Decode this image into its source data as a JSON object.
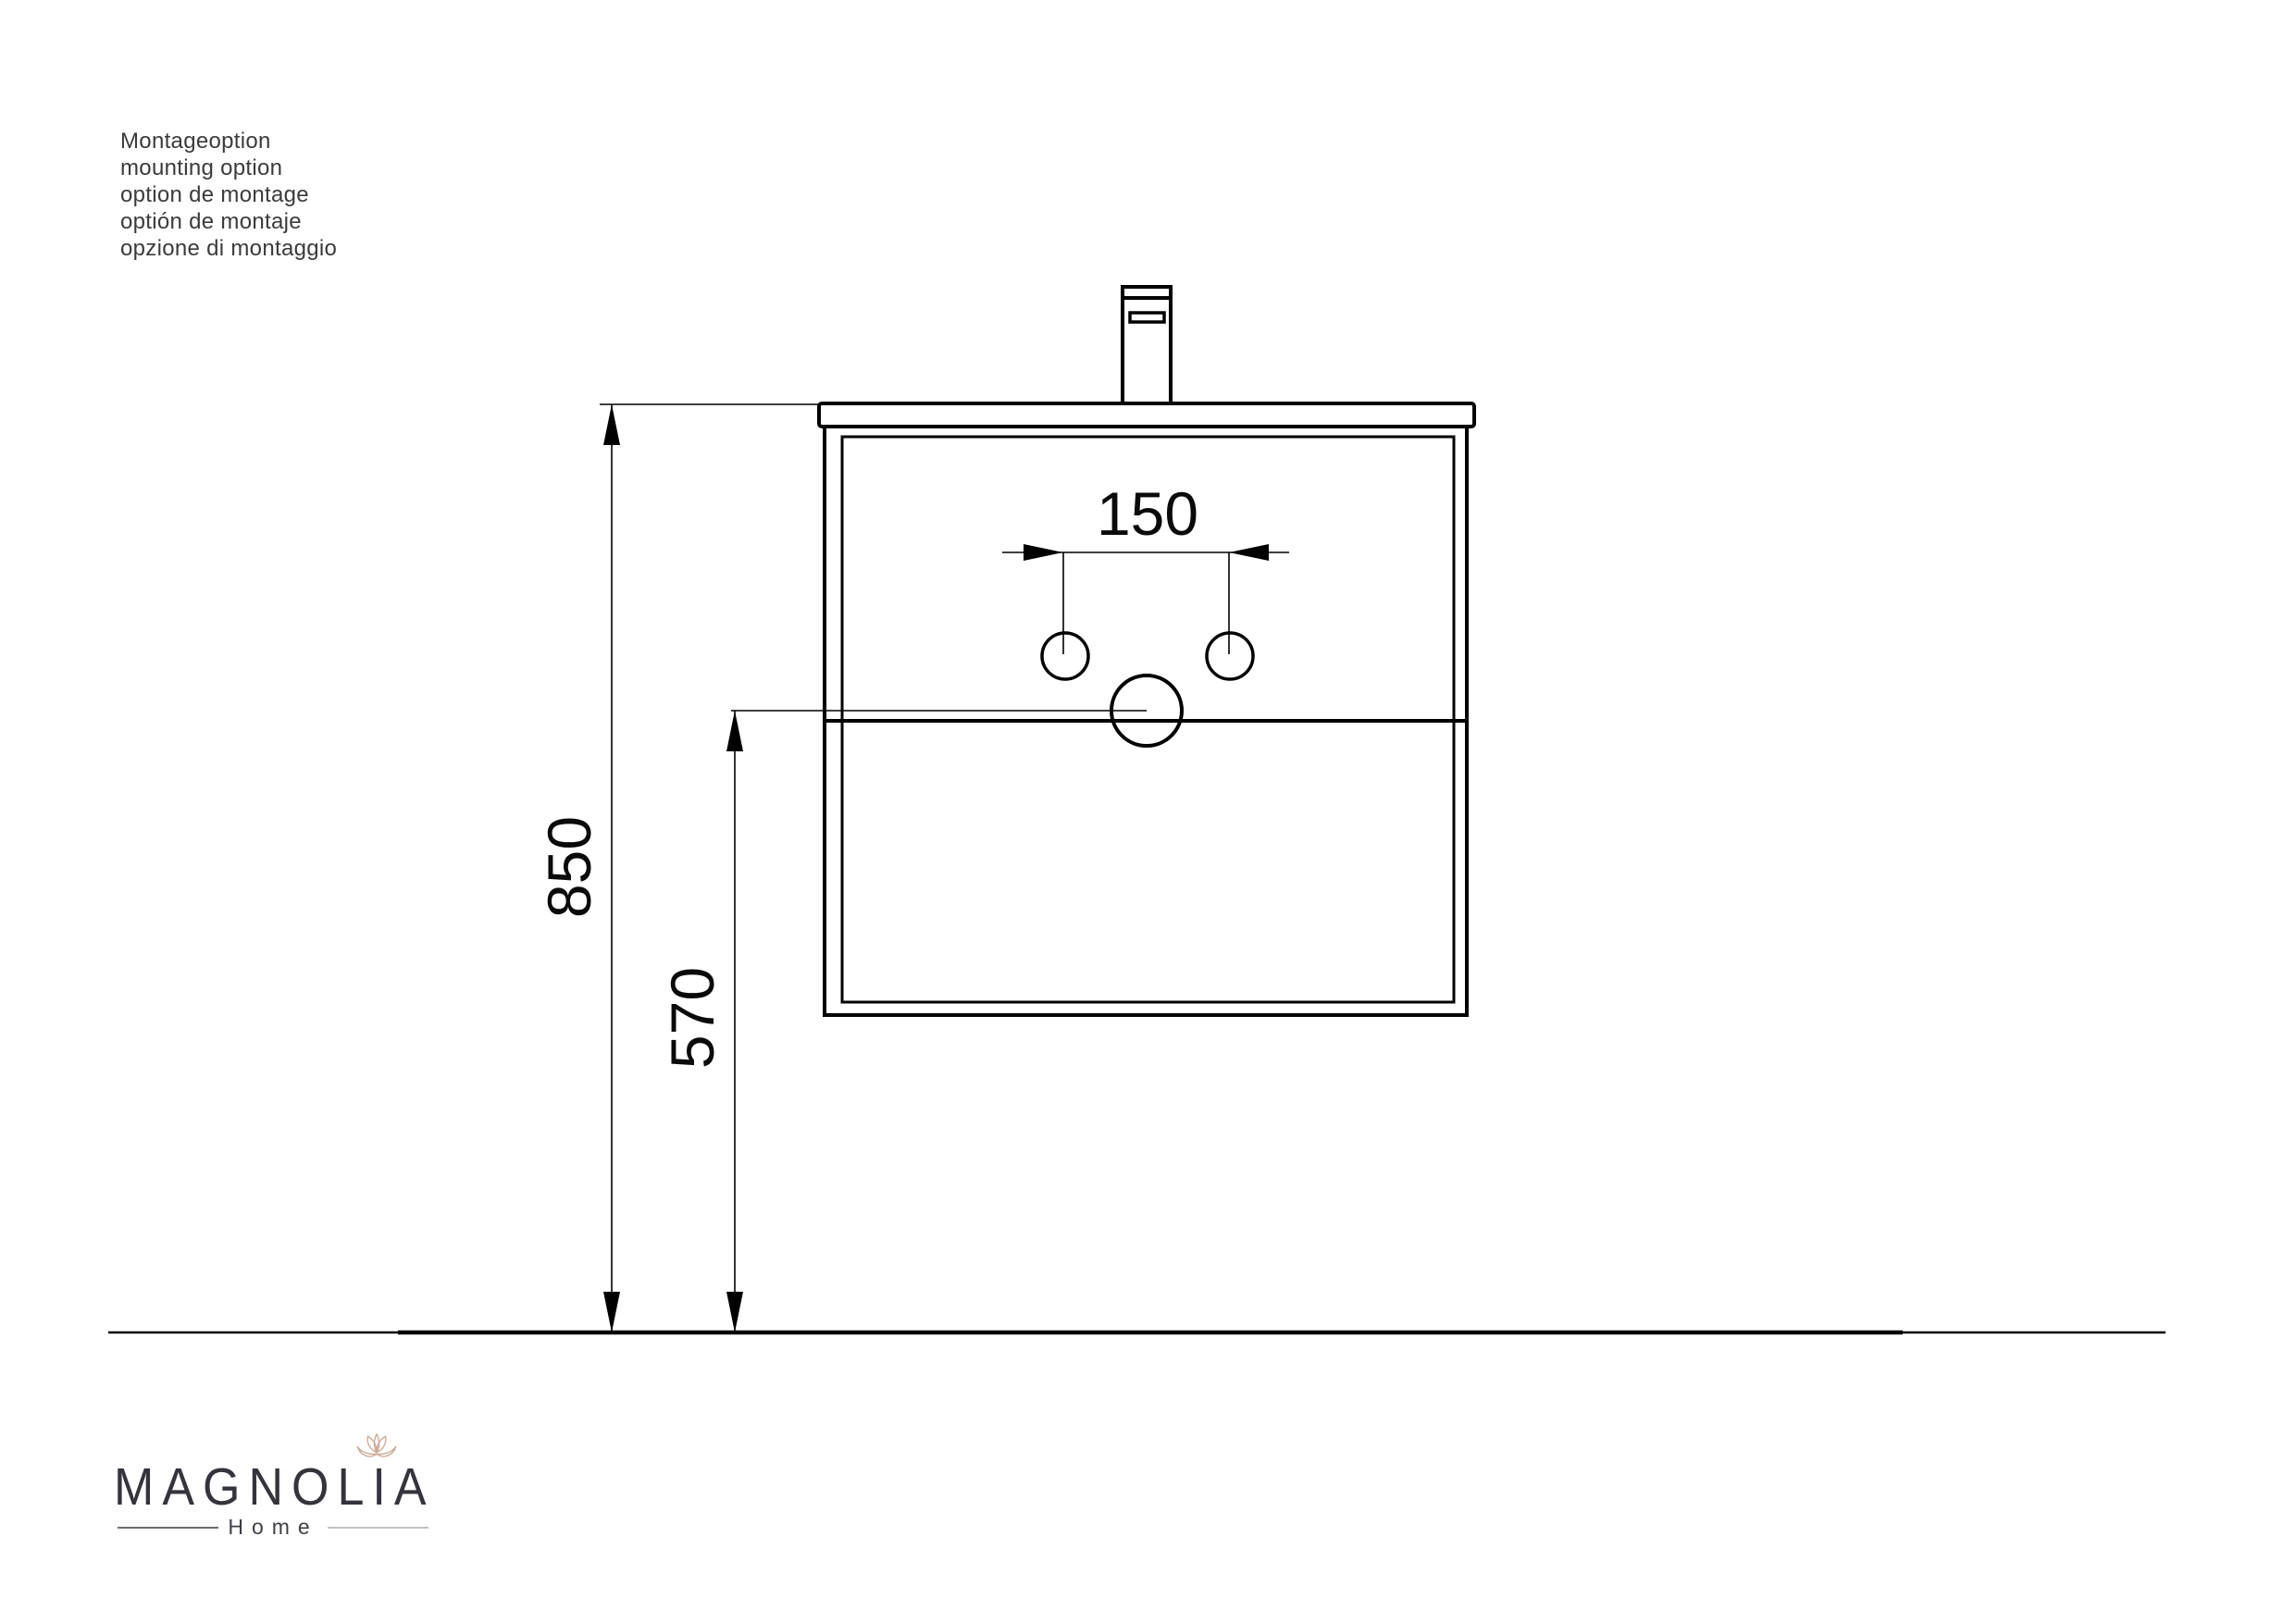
{
  "header": {
    "lines": [
      "Montageoption",
      "mounting option",
      "option de montage",
      "optión de montaje",
      "opzione di montaggio"
    ]
  },
  "drawing": {
    "dim_hole_spacing": "150",
    "dim_height_floor_to_top": "850",
    "dim_height_floor_to_drain": "570"
  },
  "logo": {
    "brand": "MAGNOLIA",
    "subtitle": "Home"
  },
  "colors": {
    "ink": "#000000",
    "header_text": "#3b3b3b",
    "logo_text": "#35343c",
    "lotus": "#c9a794",
    "logo_rule_left": "#6f6f6f",
    "logo_rule_right": "#c2c2c2"
  }
}
